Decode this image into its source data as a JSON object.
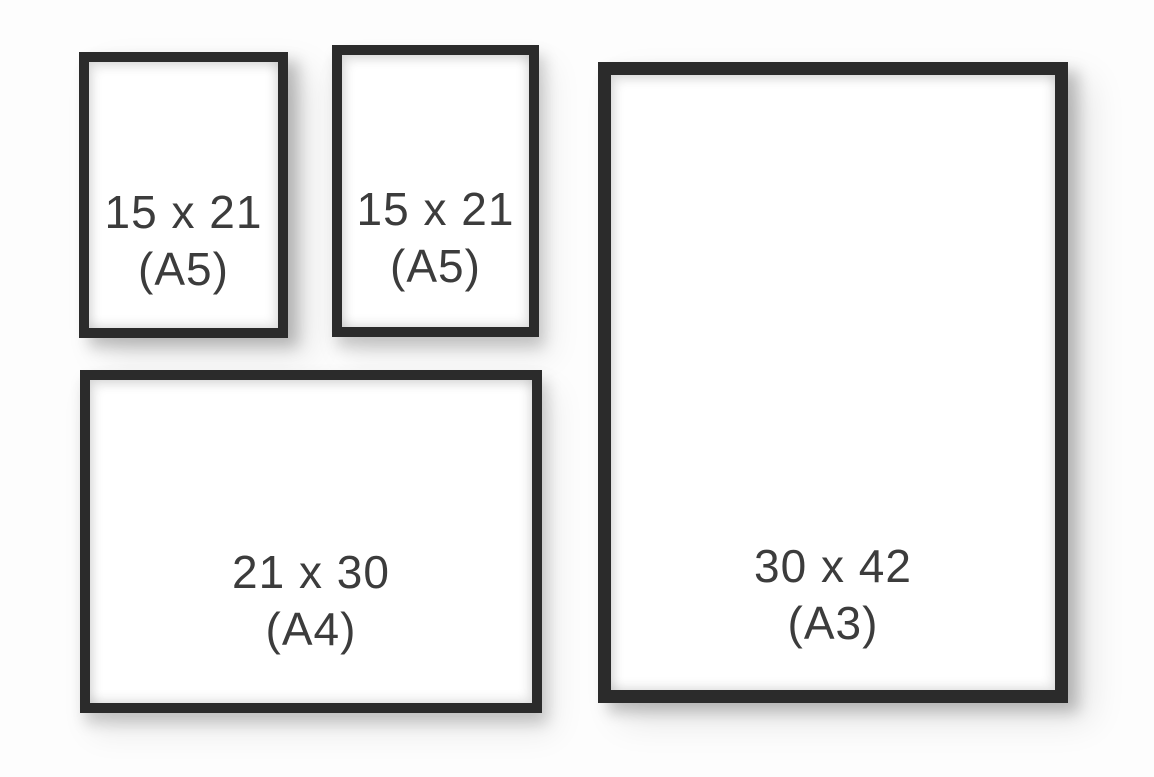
{
  "scene": {
    "description": "Picture frame size comparison",
    "background_color": "#fdfdfd",
    "frame_color": "#2b2b2b",
    "label_color": "#3c3c3c"
  },
  "frames": [
    {
      "id": "a5-left",
      "orientation": "portrait",
      "size_label": "15 x 21",
      "format_label": "(A5)"
    },
    {
      "id": "a5-middle",
      "orientation": "portrait",
      "size_label": "15 x 21",
      "format_label": "(A5)"
    },
    {
      "id": "a3-right",
      "orientation": "portrait",
      "size_label": "30 x 42",
      "format_label": "(A3)"
    },
    {
      "id": "a4-bottom",
      "orientation": "landscape",
      "size_label": "21 x 30",
      "format_label": "(A4)"
    }
  ]
}
